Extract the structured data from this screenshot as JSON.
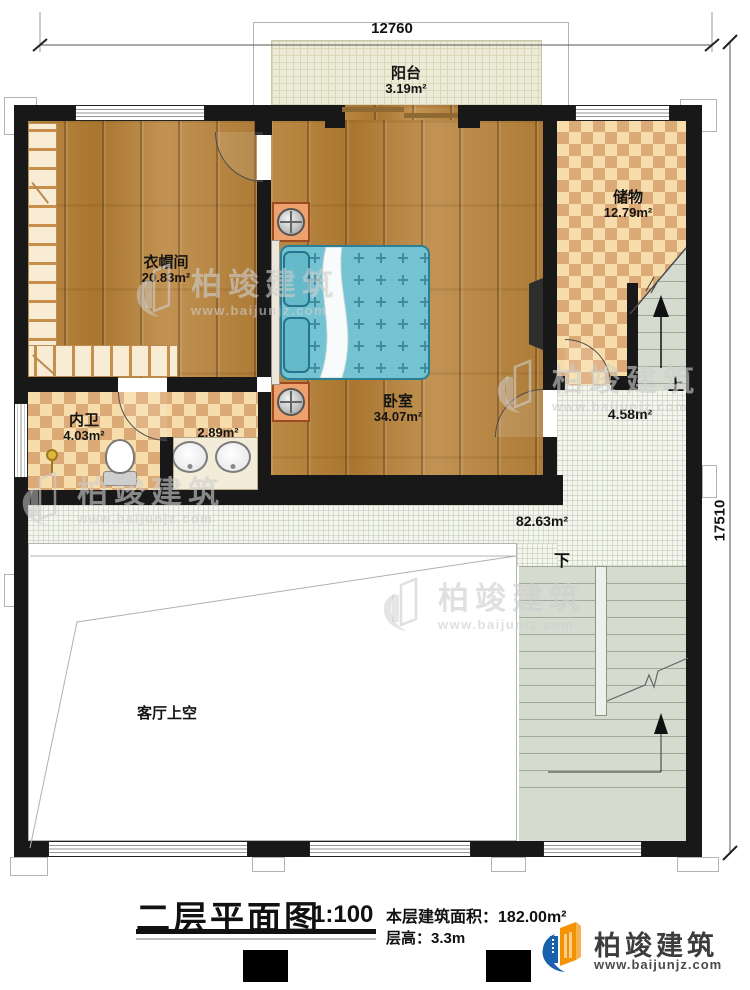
{
  "plan": {
    "dimensions": {
      "top": "12760",
      "right": "17510"
    },
    "rooms": {
      "balcony": {
        "label": "阳台",
        "area": "3.19m²"
      },
      "storage": {
        "label": "储物",
        "area": "12.79m²"
      },
      "cloakroom": {
        "label": "衣帽间",
        "area": "20.83m²"
      },
      "bedroom": {
        "label": "卧室",
        "area": "34.07m²"
      },
      "bathroom": {
        "label": "内卫",
        "area": "4.03m²"
      },
      "vanity": {
        "area": "2.89m²"
      },
      "stair_landing": {
        "area": "4.58m²"
      },
      "corridor": {
        "area": "82.63m²"
      },
      "living_void": {
        "label": "客厅上空"
      }
    },
    "stairs": {
      "up": "上",
      "down": "下"
    }
  },
  "title_block": {
    "title": "二层平面图",
    "scale": "1:100",
    "floor_area_label": "本层建筑面积：",
    "floor_area_value": "182.00m²",
    "floor_height_label": "层高：",
    "floor_height_value": "3.3m"
  },
  "branding": {
    "logo_text": "柏竣建筑",
    "logo_url": "www.baijunjz.com",
    "watermark_text": "柏竣建筑",
    "watermark_url": "www.baijunjz.com"
  },
  "colors": {
    "wall": "#181818",
    "wood_floor": "#b5833f",
    "tile_checker": "#dcaa77",
    "bed_teal": "#74c3d2",
    "logo_blue": "#1961ac",
    "logo_orange": "#f29200"
  }
}
